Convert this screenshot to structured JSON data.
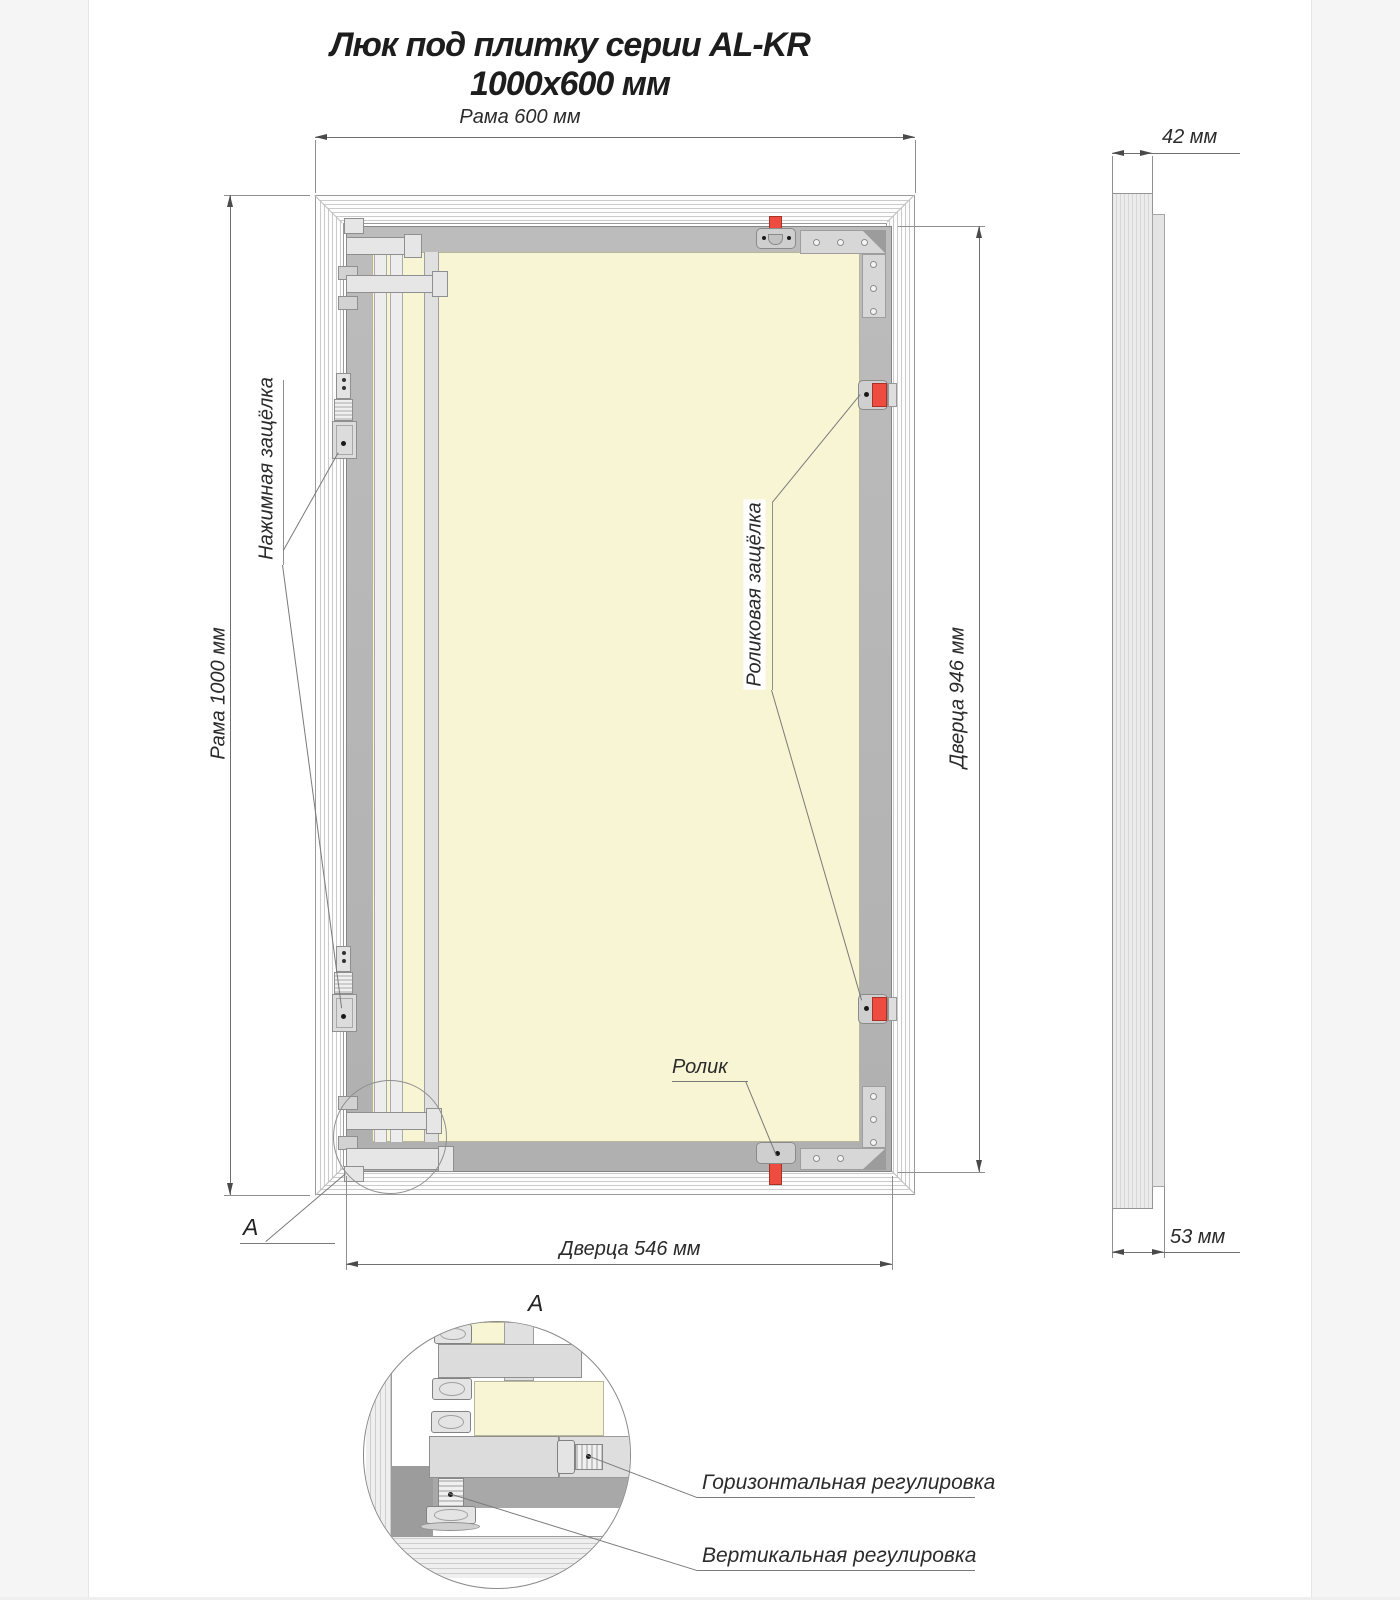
{
  "title": "Люк под плитку серии AL-KR 1000x600 мм",
  "front_view": {
    "dim_frame_width": "Рама 600 мм",
    "dim_frame_height": "Рама 1000 мм",
    "dim_door_height": "Дверца 946 мм",
    "dim_door_width": "Дверца 546 мм",
    "label_push_latch": "Нажимная защёлка",
    "label_roller_latch": "Роликовая защёлка",
    "label_roller": "Ролик",
    "detail_marker": "A"
  },
  "side_view": {
    "dim_depth_frame": "42 мм",
    "dim_depth_total": "53 мм"
  },
  "detail_view": {
    "marker": "A",
    "label_horizontal_adjustment": "Горизонтальная регулировка",
    "label_vertical_adjustment": "Вертикальная регулировка"
  },
  "colors": {
    "accent_red": "#ee4c41",
    "panel_cream": "#f8f5d5",
    "rail_gray": "#b4b4b4"
  }
}
